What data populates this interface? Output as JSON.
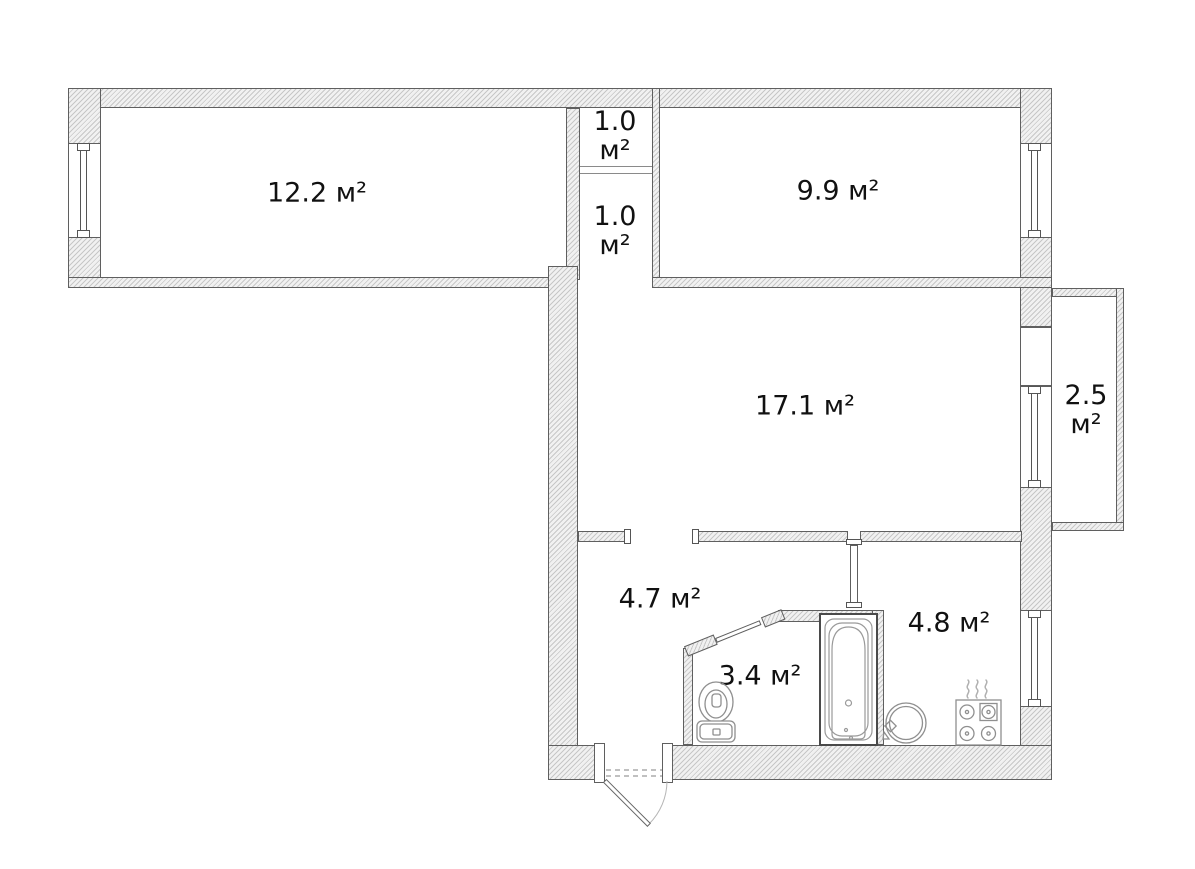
{
  "title": "apartment-floor-plan",
  "rooms": [
    {
      "id": "room-top-left",
      "area_label": "12.2 м²"
    },
    {
      "id": "closet-upper",
      "area_value": "1.0",
      "area_unit": "м²"
    },
    {
      "id": "closet-lower",
      "area_value": "1.0",
      "area_unit": "м²"
    },
    {
      "id": "room-top-right",
      "area_label": "9.9 м²"
    },
    {
      "id": "room-main",
      "area_label": "17.1 м²"
    },
    {
      "id": "balcony",
      "area_value": "2.5",
      "area_unit": "м²"
    },
    {
      "id": "hallway",
      "area_label": "4.7 м²"
    },
    {
      "id": "bathroom",
      "area_label": "3.4 м²"
    },
    {
      "id": "kitchen",
      "area_label": "4.8 м²"
    }
  ],
  "fixtures": [
    "toilet",
    "bathtub",
    "sink",
    "stove",
    "steam",
    "entrance-door",
    "bathroom-door",
    "kitchen-door",
    "window",
    "balcony-door"
  ],
  "colors": {
    "wall_outline": "#5f5f5f",
    "hatch_line": "#c7c7c7",
    "fixture_line": "#8f8f8f",
    "text": "#111111",
    "background": "#ffffff"
  }
}
